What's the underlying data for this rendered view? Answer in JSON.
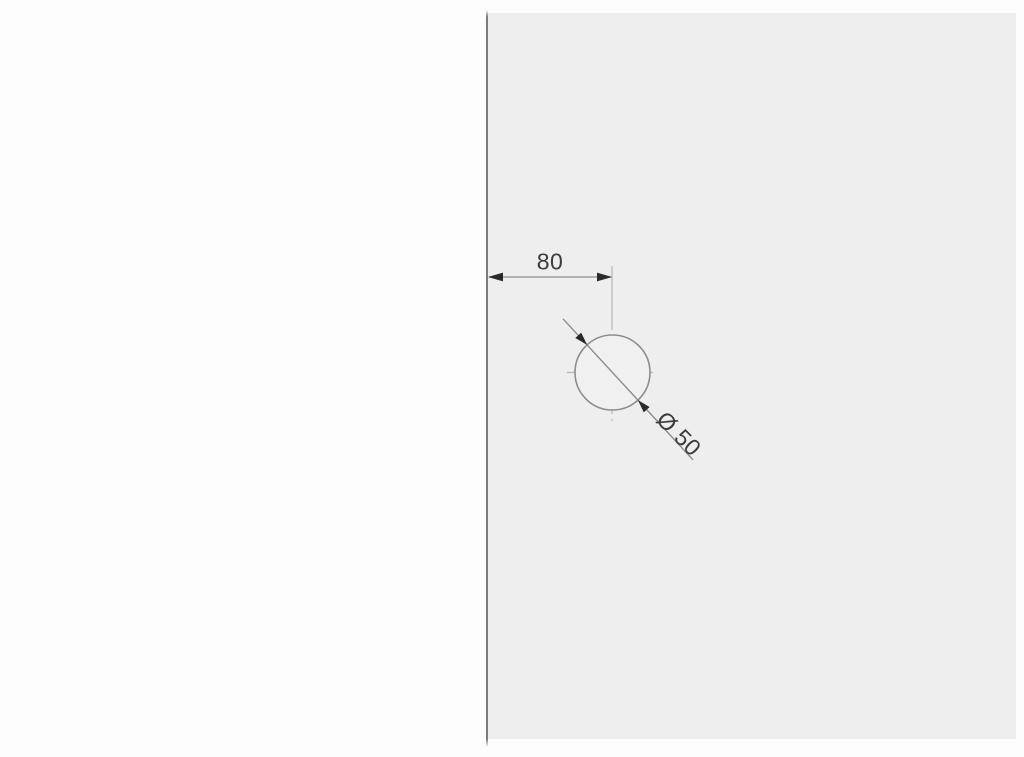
{
  "drawing": {
    "labels": {
      "offset_dimension": "80",
      "diameter_dimension": "Ø 50"
    },
    "colors": {
      "background": "#fdfdfd",
      "panel": "#efeeee",
      "panel_edge_line": "#7c7c7c",
      "drawing_line": "#8d8d8d",
      "centerline": "#b5b5b5",
      "arrow": "#2a2a2a",
      "text": "#3b3b3b"
    }
  }
}
